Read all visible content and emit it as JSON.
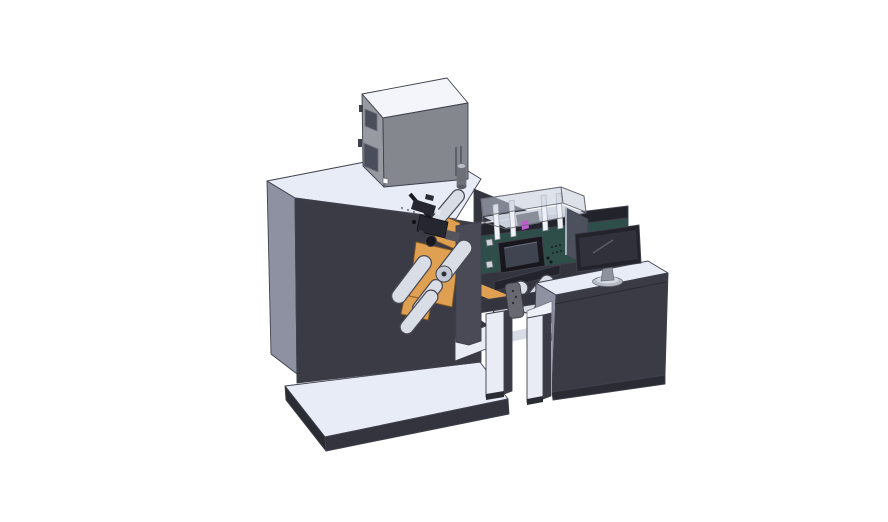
{
  "canvas": {
    "width": 888,
    "height": 522,
    "background": "#ffffff"
  },
  "palette": {
    "background": "#ffffff",
    "topLight": "#e8ecf7",
    "topLighter": "#f3f5fa",
    "sideMedium": "#8d91a2",
    "darkFace": "#3b3b45",
    "darkFace2": "#34343e",
    "kickBand": "#2b2b34",
    "grayBoxLeft": "#989aa2",
    "grayBoxFront": "#85878f",
    "windowPanel": "#4a4e5a",
    "orange": "#e0a052",
    "orangeEdge": "#8a5a20",
    "green": "#2e4f49",
    "hmiFrame": "#17171d",
    "hmiScreen": "#3f4450",
    "rollerLight": "#d9dde6",
    "rollerOutline": "#4a4a52",
    "acrylic": "rgba(195,203,217,0.55)",
    "acrylicInterior": "#d3d9e4",
    "acrylicEdge": "#6a6c76",
    "magenta": "#c05ad0",
    "coverPlate": "#4a4a56",
    "monitorBezel": "#23232b",
    "monitorScreen": "#31313b",
    "monitorHighlight": "#5d5d6b",
    "standGray": "#8e929e",
    "baseGray": "#b6bbc6",
    "baseGrayTop": "#d6dae2",
    "sensorGray": "#686870",
    "legLight": "#e9ecf4",
    "beamDark": "#23232b",
    "backPanel": "#4d515d",
    "backPanelEdge": "#a8aeba",
    "blackPart": "#1c1c22",
    "blackPart2": "#262630",
    "detailGray": "#55555f",
    "white": "#ffffff"
  },
  "parts": [
    {
      "name": "left-platform",
      "label": "machine base platform"
    },
    {
      "name": "unwind-cabinet",
      "label": "large left cabinet"
    },
    {
      "name": "dryer-box",
      "label": "gray box on top of cabinet"
    },
    {
      "name": "exhaust-cylinder",
      "label": "small cylinder beside dryer box"
    },
    {
      "name": "printhead-assembly",
      "label": "black print head mechanism"
    },
    {
      "name": "guide-rollers",
      "label": "web guide rollers"
    },
    {
      "name": "orange-web-plates",
      "label": "orange media plates"
    },
    {
      "name": "turret-cover-plate",
      "label": "central cover plate"
    },
    {
      "name": "inspection-unit",
      "label": "green unit with HMI and acrylic cover"
    },
    {
      "name": "hmi-panel",
      "label": "touchscreen control panel"
    },
    {
      "name": "web-stand",
      "label": "frame stand between units"
    },
    {
      "name": "sensor-bracket",
      "label": "gray sensor bracket"
    },
    {
      "name": "operator-desk",
      "label": "right desk cabinet"
    },
    {
      "name": "desk-monitor",
      "label": "computer monitor on desk"
    },
    {
      "name": "back-panel",
      "label": "second panel behind monitor"
    }
  ]
}
